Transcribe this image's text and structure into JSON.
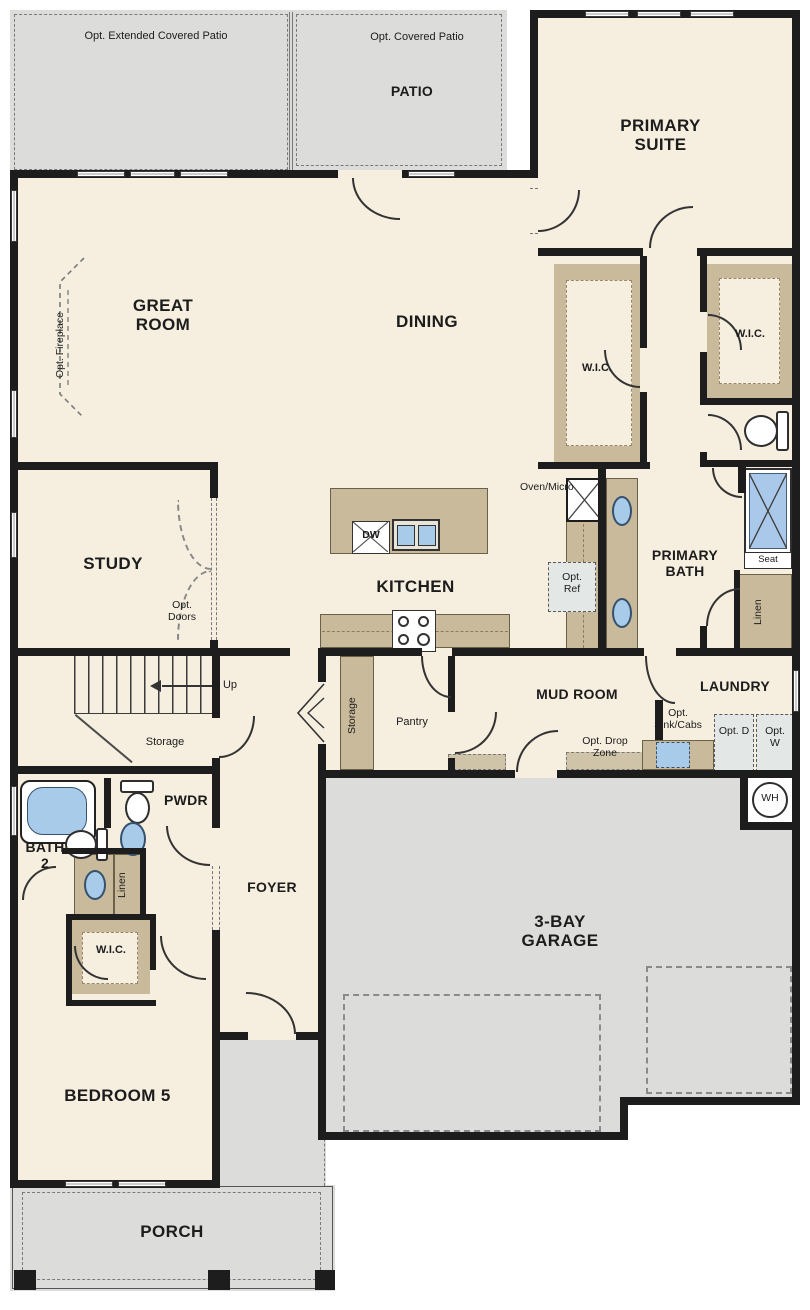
{
  "plan_title": "Single-story floor plan",
  "colors": {
    "floor": "#f6efdf",
    "outdoor": "#dcdcda",
    "cabinet": "#c9ba9b",
    "fixture_blue": "#a8cbe9",
    "wall": "#1d1d1d",
    "optional_box": "#e3e7e6"
  },
  "rooms": {
    "great_room": "GREAT ROOM",
    "dining": "DINING",
    "primary_suite": "PRIMARY SUITE",
    "study": "STUDY",
    "kitchen": "KITCHEN",
    "primary_bath": "PRIMARY BATH",
    "mud_room": "MUD ROOM",
    "laundry": "LAUNDRY",
    "foyer": "FOYER",
    "bath2": "BATH 2",
    "pwdr": "PWDR",
    "bedroom5": "BEDROOM 5",
    "garage": "3-BAY GARAGE",
    "porch": "PORCH",
    "patio": "PATIO",
    "wic": "W.I.C."
  },
  "features": {
    "opt_extended_patio": "Opt. Extended Covered Patio",
    "opt_covered_patio": "Opt. Covered Patio",
    "opt_fireplace": "Opt. Fireplace",
    "opt_doors": "Opt. Doors",
    "opt_ref": "Opt. Ref",
    "opt_sink_cabs": "Opt. Sink/Cabs",
    "opt_d": "Opt. D",
    "opt_w": "Opt. W",
    "opt_drop_zone": "Opt. Drop Zone",
    "oven_micro": "Oven/Micro",
    "dw": "DW",
    "seat": "Seat",
    "linen": "Linen",
    "storage": "Storage",
    "pantry": "Pantry",
    "up": "Up",
    "wh": "WH"
  }
}
